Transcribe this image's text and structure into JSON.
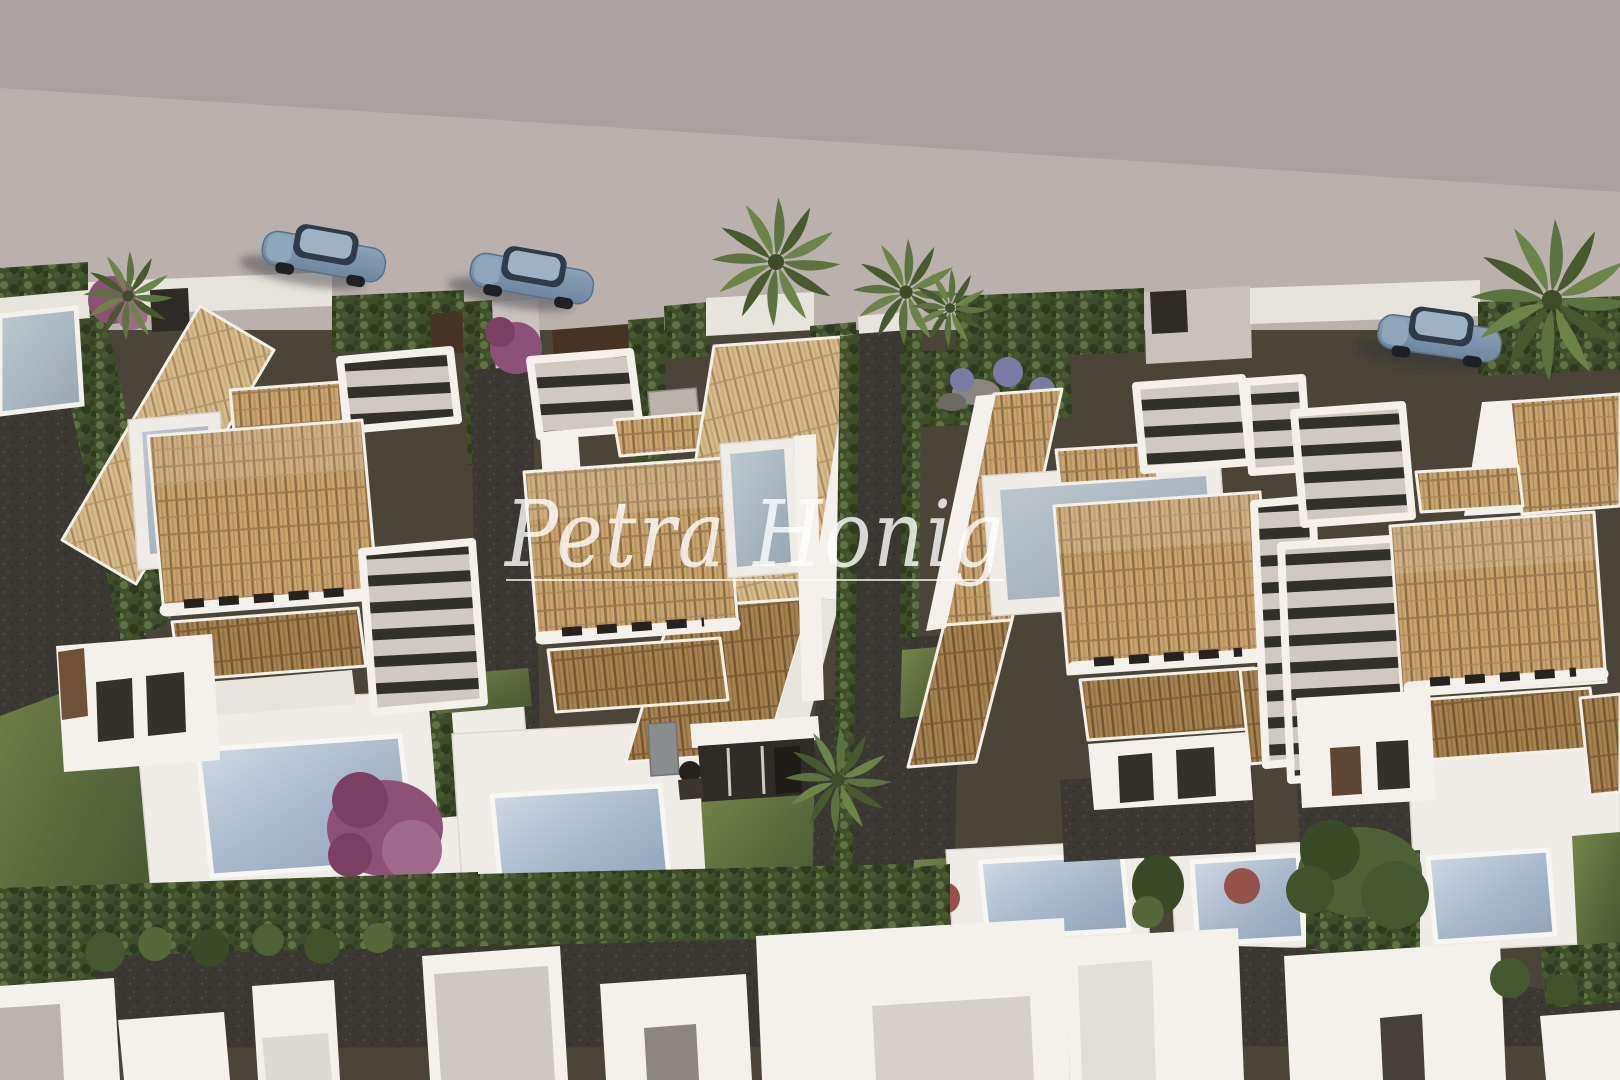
{
  "meta": {
    "kind": "aerial 3d architectural rendering",
    "description": "Bird's-eye render of a row of modern white new-build villas with terracotta tiled roofs, dark slatted pergolas, private pools, lawns and clipped hedges along a quiet street with parked cars and palm trees."
  },
  "watermark": {
    "text": "Petra Honig",
    "style": "white handwritten script with thin underline",
    "color": "#ffffff",
    "opacity": 0.8,
    "underline": true
  },
  "street": {
    "surface": "two-tone light asphalt",
    "parked_car_count": 3,
    "car_color_name": "steel blue",
    "note": "third car partially hidden behind palm at right edge"
  },
  "villas": [
    {
      "id": "villa-1",
      "roof": "terracotta hip roof with dark vent row",
      "features": [
        "tilted carport tile roof",
        "slatted pergola",
        "roof terrace",
        "private pool",
        "lawn",
        "large bougainvillea"
      ]
    },
    {
      "id": "villa-2",
      "roof": "terracotta hip roof plus long tilted gable plane",
      "features": [
        "entry pergola",
        "blue-grey roof terrace",
        "private pool",
        "dark porch with bbq",
        "palm tree",
        "lawn"
      ]
    },
    {
      "id": "villa-3",
      "roof": "terracotta hip roof plus tilted plane",
      "features": [
        "two pergolas",
        "roof terrace",
        "two pools on white deck",
        "gravel path",
        "lawn patches"
      ]
    },
    {
      "id": "villa-4",
      "roof": "terracotta hip roof",
      "features": [
        "two slatted pergolas",
        "white gable wall",
        "private pool",
        "garden tree",
        "lawn strip"
      ]
    }
  ],
  "landscape": {
    "pool_count": 5,
    "palm_tree_count": 6,
    "hedges": "clipped dark-green hedges dividing the plots and lining the bottom lane",
    "shrubs": [
      "purple bougainvillea",
      "lavender-blue flower bushes",
      "red shrubs",
      "round green bushes"
    ],
    "bottom_row": "white roof volumes of the next row of houses"
  },
  "palette": {
    "road_upper": "#a9a19f",
    "road_lower": "#bab1ae",
    "wall_white": "#f4f1ec",
    "wall_dim": "#e7e3dd",
    "deck_white": "#efece8",
    "roof_tile": "#c8a46f",
    "roof_tile_light": "#d6ba8c",
    "roof_tile_dark": "#a6824f",
    "roof_stripe": "#8f6c44",
    "slat_dark": "#32302b",
    "slat_gap": "#cfc9c1",
    "hedge_base": "#3f4d2a",
    "hedge_light": "#5f7342",
    "hedge_dark": "#2e3a1f",
    "lawn_light": "#76864b",
    "lawn_dark": "#46552f",
    "gravel": "#3b3834",
    "soil": "#4a4538",
    "pool_light": "#d4dce6",
    "pool_dark": "#8fa2b9",
    "car_body": "#7e95ac",
    "car_glass": "#2f3b49",
    "wood_brown": "#6e5136",
    "door_brown": "#5d4632",
    "bougainvillea": "#8d5178",
    "shrub_red": "#96524a",
    "watermark_white": "#ffffff"
  }
}
